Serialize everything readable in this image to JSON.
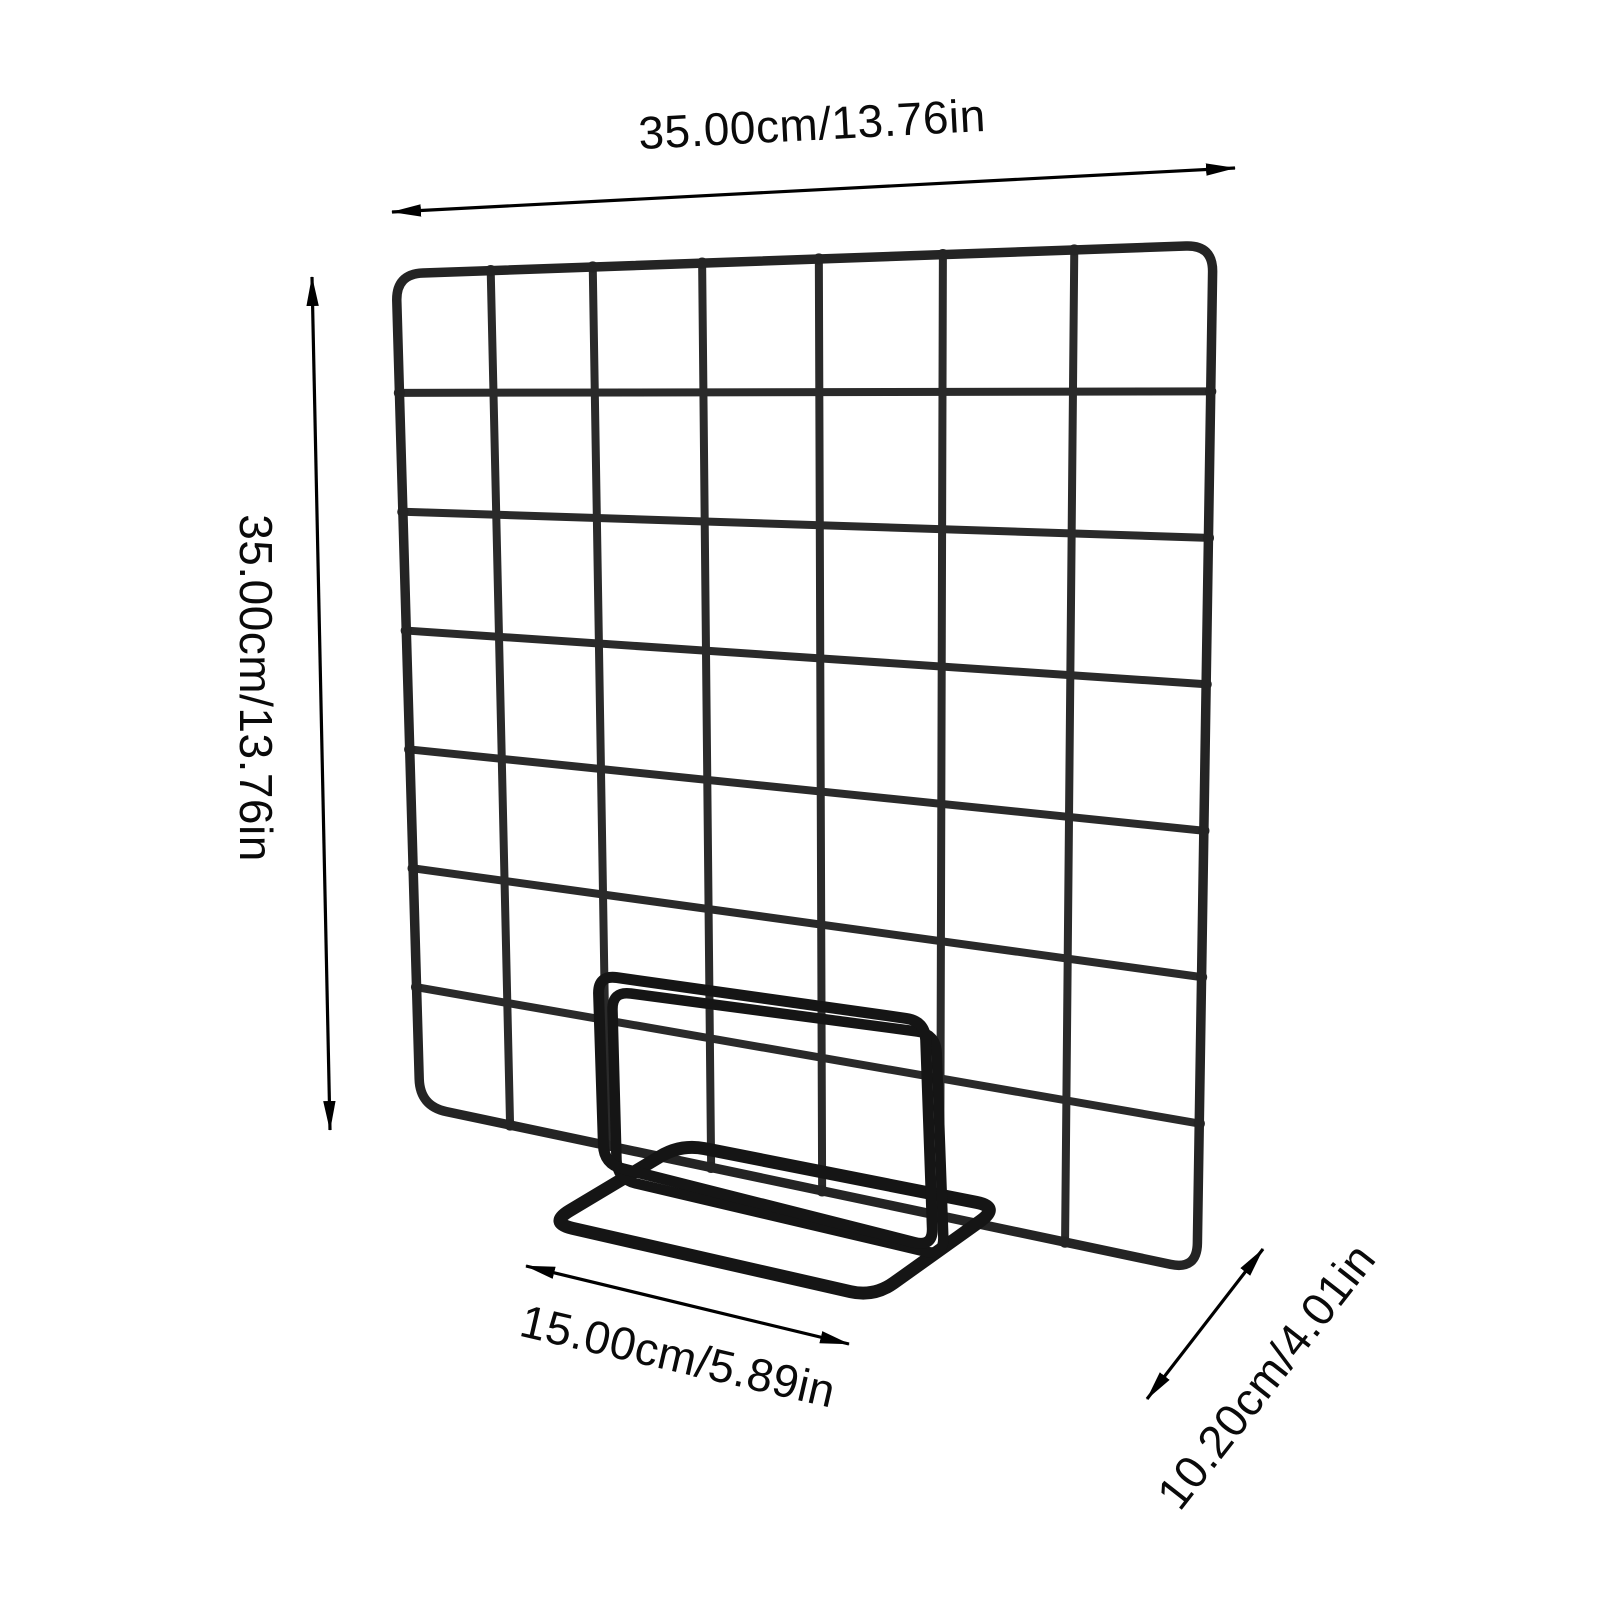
{
  "page": {
    "background": "#ffffff",
    "kind": "product-dimension-diagram"
  },
  "product": {
    "name": "wire-grid-display-panel-with-stand",
    "grid_columns": 7,
    "grid_rows": 7,
    "panel_wire_color": "#2a2a2a",
    "panel_frame_color": "#242424",
    "stand_wire_color": "#151515",
    "dimension_line_color": "#000000"
  },
  "dimensions": {
    "width": {
      "label": "35.00cm/13.76in",
      "side": "top"
    },
    "height": {
      "label": "35.00cm/13.76in",
      "side": "left"
    },
    "base_width": {
      "label": "15.00cm/5.89in",
      "side": "bottom-left"
    },
    "base_depth": {
      "label": "10.20cm/4.01in",
      "side": "bottom-right"
    }
  }
}
